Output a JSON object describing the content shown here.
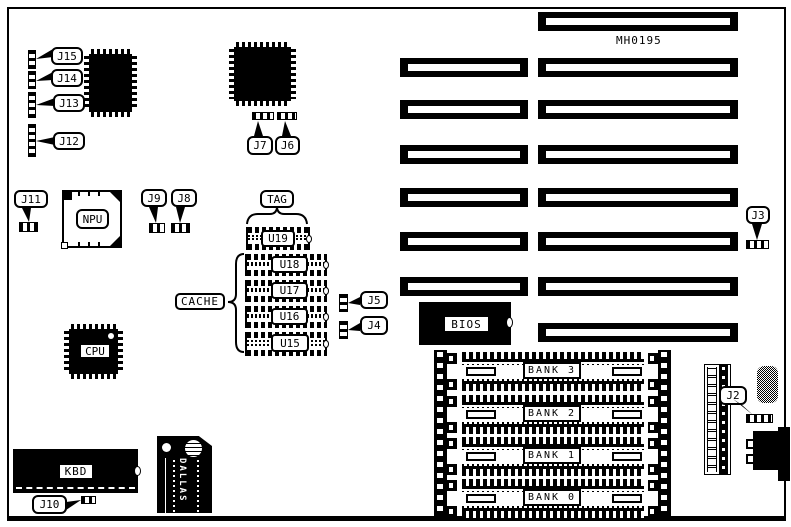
{
  "board": {
    "part_number": "MH0195"
  },
  "labels": {
    "j2": "J2",
    "j3": "J3",
    "j4": "J4",
    "j5": "J5",
    "j6": "J6",
    "j7": "J7",
    "j8": "J8",
    "j9": "J9",
    "j10": "J10",
    "j11": "J11",
    "j12": "J12",
    "j13": "J13",
    "j14": "J14",
    "j15": "J15"
  },
  "chips": {
    "npu": "NPU",
    "cpu": "CPU",
    "kbd": "KBD",
    "bios": "BIOS",
    "tag": "TAG",
    "cache": "CACHE",
    "u19": "U19",
    "u18": "U18",
    "u17": "U17",
    "u16": "U16",
    "u15": "U15"
  },
  "memory_banks": {
    "bank3": "BANK 3",
    "bank2": "BANK 2",
    "bank1": "BANK 1",
    "bank0": "BANK 0"
  },
  "rtc": {
    "brand": "DALLAS"
  },
  "colors": {
    "ink": "#000000",
    "paper": "#ffffff"
  }
}
